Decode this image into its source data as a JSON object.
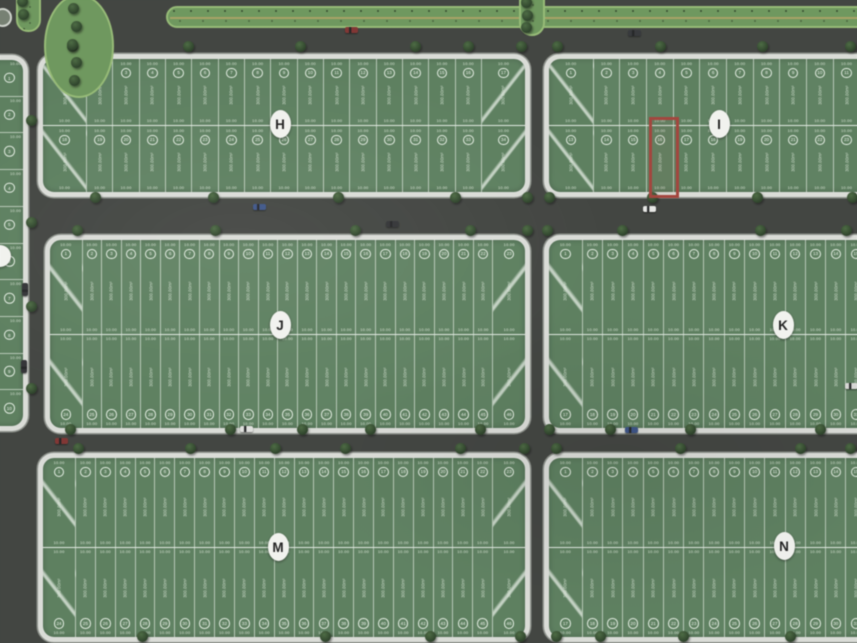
{
  "colors": {
    "road": "#3f423e",
    "block_green": "#4d7b50",
    "curb": "#d9dcd6",
    "curb_edge": "#868c83",
    "median_green": "#5e9548",
    "median_border": "#8abb60",
    "median_line": "#b3a14f",
    "label_bg": "#f2f3ee",
    "label_text": "#141414",
    "highlight": "#b2342a"
  },
  "plot_text": {
    "area_label": "300.00m²",
    "width_label": "10.00"
  },
  "blocks": [
    {
      "label": "H",
      "x": 38,
      "y": 54,
      "w": 492,
      "h": 143,
      "plots_per_row": 17,
      "mirror_bottom": false,
      "cut_right": false,
      "label_cx": 280,
      "label_cy": 124
    },
    {
      "label": "I",
      "x": 544,
      "y": 54,
      "w": 342,
      "h": 143,
      "plots_per_row": 12,
      "mirror_bottom": false,
      "cut_right": true,
      "label_cx": 719,
      "label_cy": 124
    },
    {
      "label": "J",
      "x": 45,
      "y": 235,
      "w": 485,
      "h": 198,
      "plots_per_row": 23,
      "mirror_bottom": true,
      "cut_right": false,
      "label_cx": 280,
      "label_cy": 325
    },
    {
      "label": "K",
      "x": 544,
      "y": 235,
      "w": 342,
      "h": 198,
      "plots_per_row": 16,
      "mirror_bottom": true,
      "cut_right": true,
      "label_cx": 783,
      "label_cy": 325
    },
    {
      "label": "M",
      "x": 38,
      "y": 453,
      "w": 492,
      "h": 189,
      "plots_per_row": 23,
      "mirror_bottom": true,
      "cut_right": false,
      "label_cx": 278,
      "label_cy": 547
    },
    {
      "label": "N",
      "x": 544,
      "y": 453,
      "w": 342,
      "h": 189,
      "plots_per_row": 16,
      "mirror_bottom": true,
      "cut_right": true,
      "label_cx": 784,
      "label_cy": 546
    }
  ],
  "left_block": {
    "x": -42,
    "y": 55,
    "w": 70,
    "h": 376,
    "plots": 10,
    "label_cx": 0,
    "label_cy": 256
  },
  "highlight": {
    "block": "I",
    "x": 649,
    "y": 117,
    "w": 30,
    "h": 81
  },
  "medians": [
    {
      "name": "top-avenue-median",
      "x": 166,
      "y": 6,
      "w": 700,
      "h": 22,
      "radius": "11px 0 0 11px",
      "dots": true,
      "line": true
    },
    {
      "name": "vertical-median-cap",
      "x": 519,
      "y": -10,
      "w": 26,
      "h": 46,
      "radius": "0 0 13px 13px",
      "dots": true,
      "line": false
    },
    {
      "name": "top-left-median-cap",
      "x": 16,
      "y": -8,
      "w": 25,
      "h": 40,
      "radius": "0 0 12px 12px",
      "dots": true,
      "line": false
    },
    {
      "name": "park-oval",
      "x": 44,
      "y": -6,
      "w": 70,
      "h": 104,
      "radius": "50%",
      "dots": false,
      "line": false
    },
    {
      "name": "small-roundabout",
      "x": -7,
      "y": 8,
      "w": 19,
      "h": 19,
      "radius": "50%",
      "dots": false,
      "line": false,
      "gray": true
    }
  ],
  "cars": [
    [
      345,
      27,
      "#8a2622",
      "h"
    ],
    [
      628,
      30,
      "#2a2d31",
      "h"
    ],
    [
      253,
      204,
      "#2b4b8f",
      "h"
    ],
    [
      643,
      206,
      "#e6e7e3",
      "h"
    ],
    [
      386,
      221,
      "#26282b",
      "h"
    ],
    [
      55,
      438,
      "#8a2622",
      "h"
    ],
    [
      240,
      426,
      "#dfe0dc",
      "h"
    ],
    [
      625,
      427,
      "#2b4b8f",
      "h"
    ],
    [
      22,
      283,
      "#26282b",
      "v"
    ],
    [
      21,
      360,
      "#26282b",
      "v"
    ],
    [
      845,
      383,
      "#d8d8d4",
      "h"
    ]
  ],
  "trees": [
    [
      72,
      46
    ],
    [
      188,
      46
    ],
    [
      300,
      46
    ],
    [
      415,
      46
    ],
    [
      468,
      46
    ],
    [
      521,
      46
    ],
    [
      557,
      46
    ],
    [
      660,
      46
    ],
    [
      762,
      46
    ],
    [
      850,
      46
    ],
    [
      95,
      197
    ],
    [
      213,
      197
    ],
    [
      338,
      197
    ],
    [
      455,
      197
    ],
    [
      527,
      197
    ],
    [
      549,
      197
    ],
    [
      652,
      197
    ],
    [
      757,
      197
    ],
    [
      852,
      197
    ],
    [
      77,
      230
    ],
    [
      215,
      230
    ],
    [
      355,
      230
    ],
    [
      470,
      230
    ],
    [
      527,
      230
    ],
    [
      547,
      230
    ],
    [
      622,
      230
    ],
    [
      760,
      230
    ],
    [
      846,
      230
    ],
    [
      70,
      429
    ],
    [
      230,
      429
    ],
    [
      302,
      429
    ],
    [
      370,
      429
    ],
    [
      480,
      429
    ],
    [
      549,
      429
    ],
    [
      610,
      429
    ],
    [
      690,
      429
    ],
    [
      820,
      429
    ],
    [
      78,
      448
    ],
    [
      190,
      448
    ],
    [
      275,
      448
    ],
    [
      345,
      448
    ],
    [
      460,
      448
    ],
    [
      524,
      448
    ],
    [
      556,
      448
    ],
    [
      680,
      448
    ],
    [
      800,
      448
    ],
    [
      850,
      448
    ],
    [
      142,
      636
    ],
    [
      325,
      636
    ],
    [
      430,
      636
    ],
    [
      520,
      636
    ],
    [
      556,
      636
    ],
    [
      600,
      636
    ],
    [
      683,
      636
    ],
    [
      790,
      636
    ],
    [
      31,
      120
    ],
    [
      31,
      222
    ],
    [
      31,
      306
    ],
    [
      31,
      388
    ],
    [
      73,
      8
    ],
    [
      76,
      26
    ],
    [
      72,
      44
    ],
    [
      76,
      62
    ],
    [
      74,
      80
    ],
    [
      526,
      2
    ],
    [
      527,
      15
    ],
    [
      526,
      27
    ],
    [
      22,
      1
    ],
    [
      23,
      14
    ]
  ]
}
